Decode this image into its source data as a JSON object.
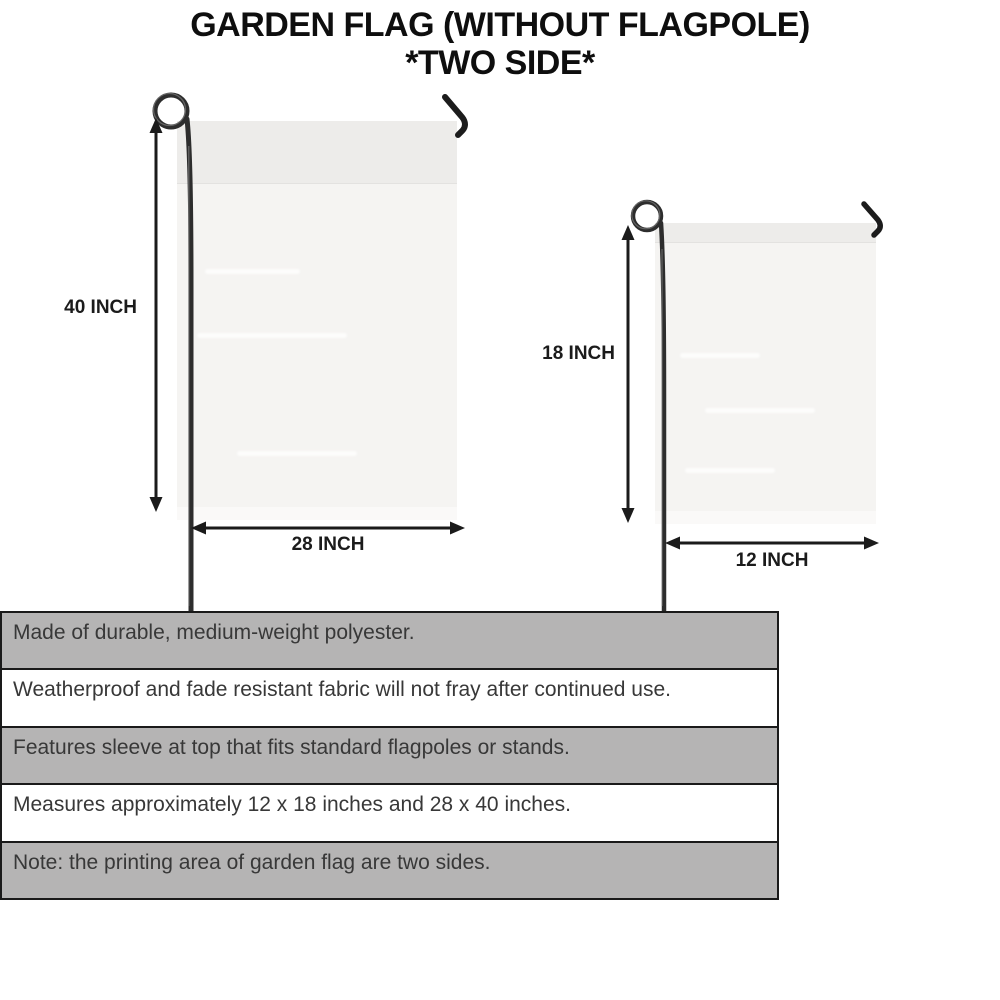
{
  "title": {
    "line1": "GARDEN FLAG (WITHOUT FLAGPOLE)",
    "line2": "*TWO SIDE*"
  },
  "diagrams": {
    "large": {
      "name": "large garden flag",
      "height_label": "40 INCH",
      "width_label": "28 INCH"
    },
    "small": {
      "name": "small garden flag",
      "height_label": "18 INCH",
      "width_label": "12 INCH"
    }
  },
  "features": [
    "Made of durable, medium-weight polyester.",
    "Weatherproof and fade resistant fabric will not fray after continued use.",
    "Features sleeve at top that fits standard flagpoles or stands.",
    "Measures approximately 12 x 18 inches and 28 x 40 inches.",
    "Note: the printing area of garden flag are two sides."
  ],
  "colors": {
    "row-gray": "#b5b4b4",
    "table-border": "#1a1a1a",
    "flag-fill": "#f5f4f2",
    "flag-sleeve": "#edecea",
    "pole-dark": "#2d2d2d",
    "arrow-black": "#1b1b1b",
    "text-dark": "#383838",
    "title-black": "#0e0e0e"
  }
}
